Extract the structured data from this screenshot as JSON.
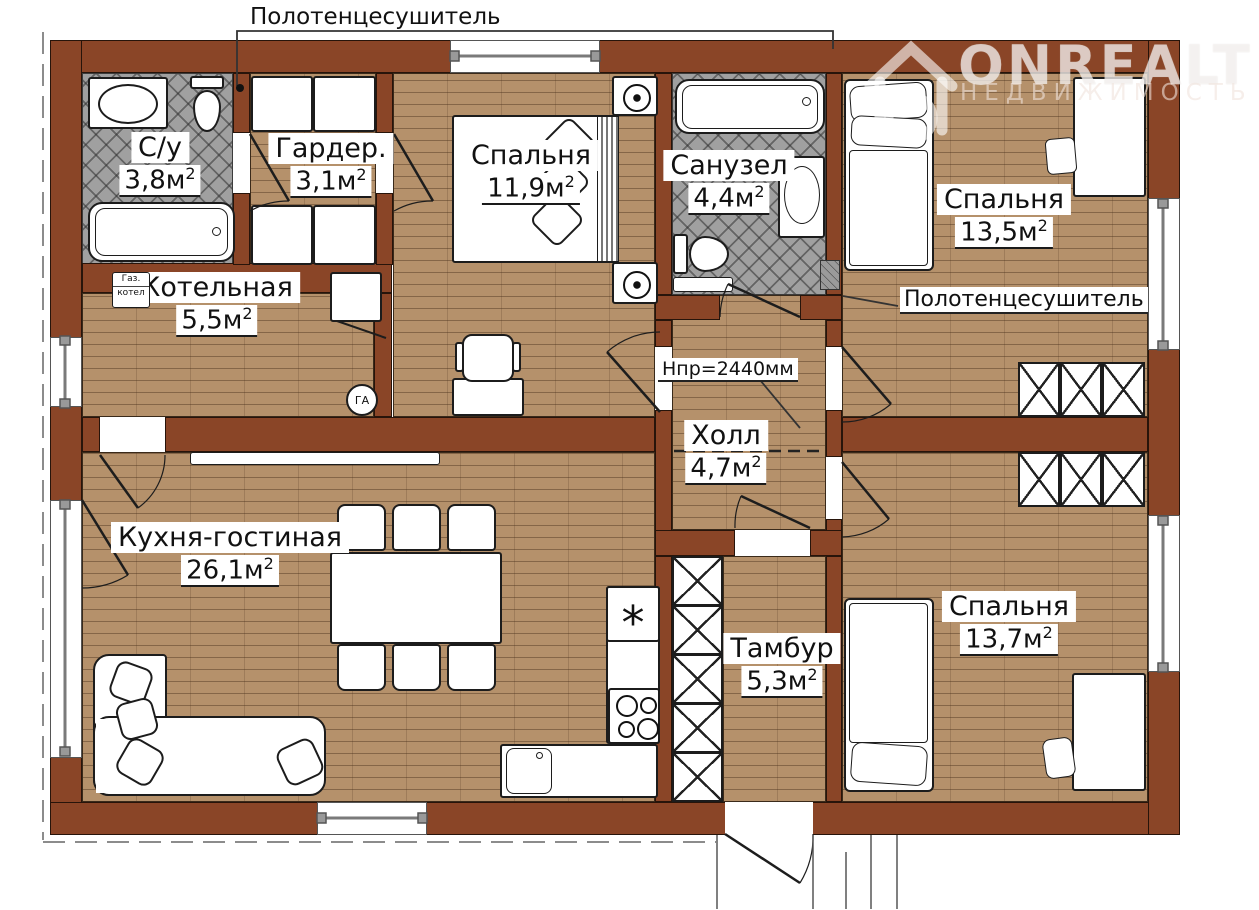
{
  "watermark": {
    "brand": "ONREALT",
    "subtitle": "НЕДВИЖИМОСТЬ"
  },
  "rooms": {
    "su": {
      "name": "С/у",
      "area": "3,8м",
      "sup": "2"
    },
    "garder": {
      "name": "Гардер.",
      "area": "3,1м",
      "sup": "2"
    },
    "bedroom_top": {
      "name": "Спальня",
      "area": "11,9м",
      "sup": "2"
    },
    "sanuzel": {
      "name": "Санузел",
      "area": "4,4м",
      "sup": "2"
    },
    "bedroom_right_top": {
      "name": "Спальня",
      "area": "13,5м",
      "sup": "2"
    },
    "kotelnaya": {
      "name": "Котельная",
      "area": "5,5м",
      "sup": "2"
    },
    "hall": {
      "name": "Холл",
      "area": "4,7м",
      "sup": "2"
    },
    "kitchen": {
      "name": "Кухня-гостиная",
      "area": "26,1м",
      "sup": "2"
    },
    "tambur": {
      "name": "Тамбур",
      "area": "5,3м",
      "sup": "2"
    },
    "bedroom_right_bottom": {
      "name": "Спальня",
      "area": "13,7м",
      "sup": "2"
    }
  },
  "annotations": {
    "towel_dryer_top": "Полотенцесушитель",
    "towel_dryer_right": "Полотенцесушитель",
    "ceiling_height": "Нпр=2440мм",
    "gas_boiler_line1": "Газ.",
    "gas_boiler_line2": "котел",
    "gas_badge": "ГА",
    "freezer_mark": "*"
  },
  "colors": {
    "wall": "#8a4527",
    "floor": "#b5916b",
    "tile": "#a0a0a0"
  }
}
